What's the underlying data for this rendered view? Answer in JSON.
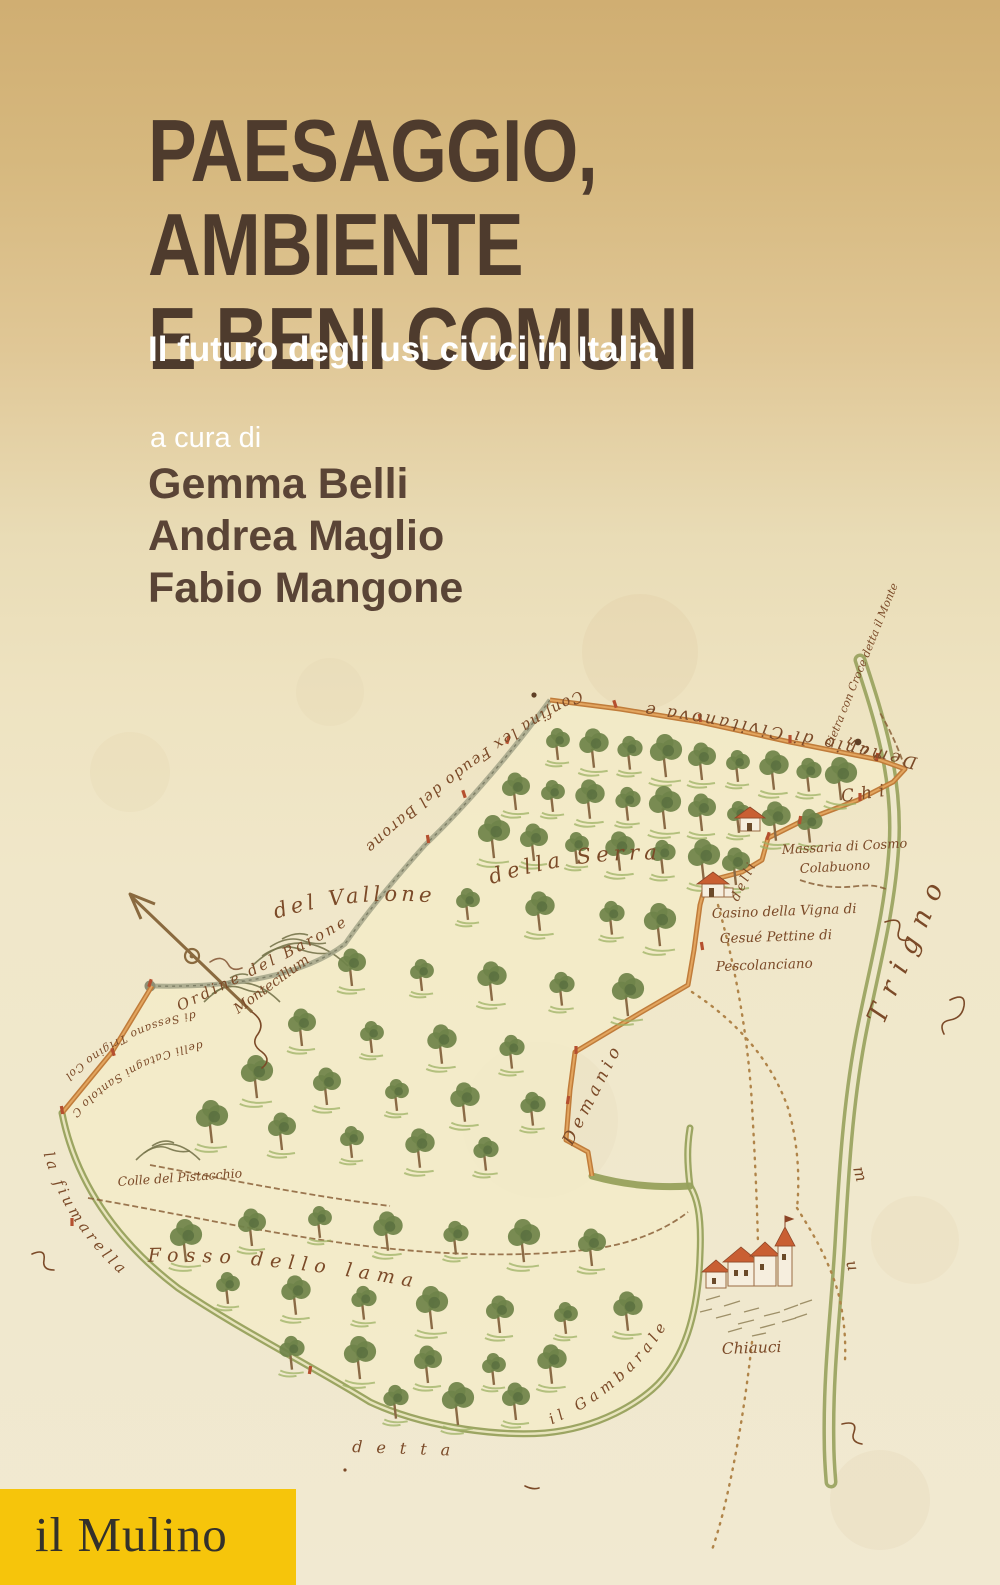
{
  "cover": {
    "title_lines": [
      "PAESAGGIO,",
      "AMBIENTE",
      "E BENI COMUNI"
    ],
    "subtitle": "Il futuro degli usi civici in Italia",
    "curated_by": "a cura di",
    "editors": [
      "Gemma Belli",
      "Andrea Maglio",
      "Fabio Mangone"
    ],
    "publisher": "il Mulino",
    "colors": {
      "bg_top": "#d0ae72",
      "bg_mid": "#e9dcb6",
      "bg_bottom": "#f1e9d1",
      "title": "#4e3b2d",
      "subtitle": "#ffffff",
      "editors": "#5a4436",
      "publisher_bg": "#f6c50b",
      "publisher_text": "#33312b",
      "map_ink": "#7b4a28",
      "boundary": "#c07c3a",
      "boundary_core": "#e2a55f",
      "field_fill": "#f3ecc8",
      "tree_green": "#6f8349",
      "tree_dark": "#5a7040",
      "trunk_brown": "#8a6a45",
      "river_green": "#97a15c",
      "river_core": "#efe8cc",
      "roof_red": "#c95f33",
      "wall_cream": "#f6eede",
      "path_gray": "#a3a488",
      "ground_green": "#9db164",
      "hill_olive": "#77744b",
      "dotted_tan": "#b08449"
    }
  },
  "map": {
    "labels": {
      "top_boundary": "Demanio di Civitanova e",
      "confina": "Confina lex Feudo del Barone",
      "pietra": "Pietra con Croce detta il Monte",
      "une": "une",
      "chi": "Chi",
      "delli": "delli",
      "massaria_line1": "Massaria di Cosmo",
      "massaria_line2": "Colabuono",
      "casino_line1": "Casino della Vigna di",
      "casino_line2": "Gesué Pettine di",
      "casino_line3": "Pescolanciano",
      "della_serra": "della Serra",
      "del_vallone": "del Vallone",
      "ordine": "Ordine del Barone",
      "montecillum": "Montecillum",
      "colle_pistacchio": "Colle del Pistacchio",
      "demanio_notch": "Demanio",
      "fosso": "Fosso dello lama",
      "detta": "detta",
      "gambarale": "il Gambarale",
      "fiumarella": "la fiumarella",
      "trigno": "Trigno",
      "sessano_line1": "di Sessano Trigino Col Bosco",
      "sessano_line2": "delli Catagni Santolo Chiauci",
      "chiauci": "Chiauci",
      "frag_m": "m",
      "frag_u": "u"
    }
  }
}
